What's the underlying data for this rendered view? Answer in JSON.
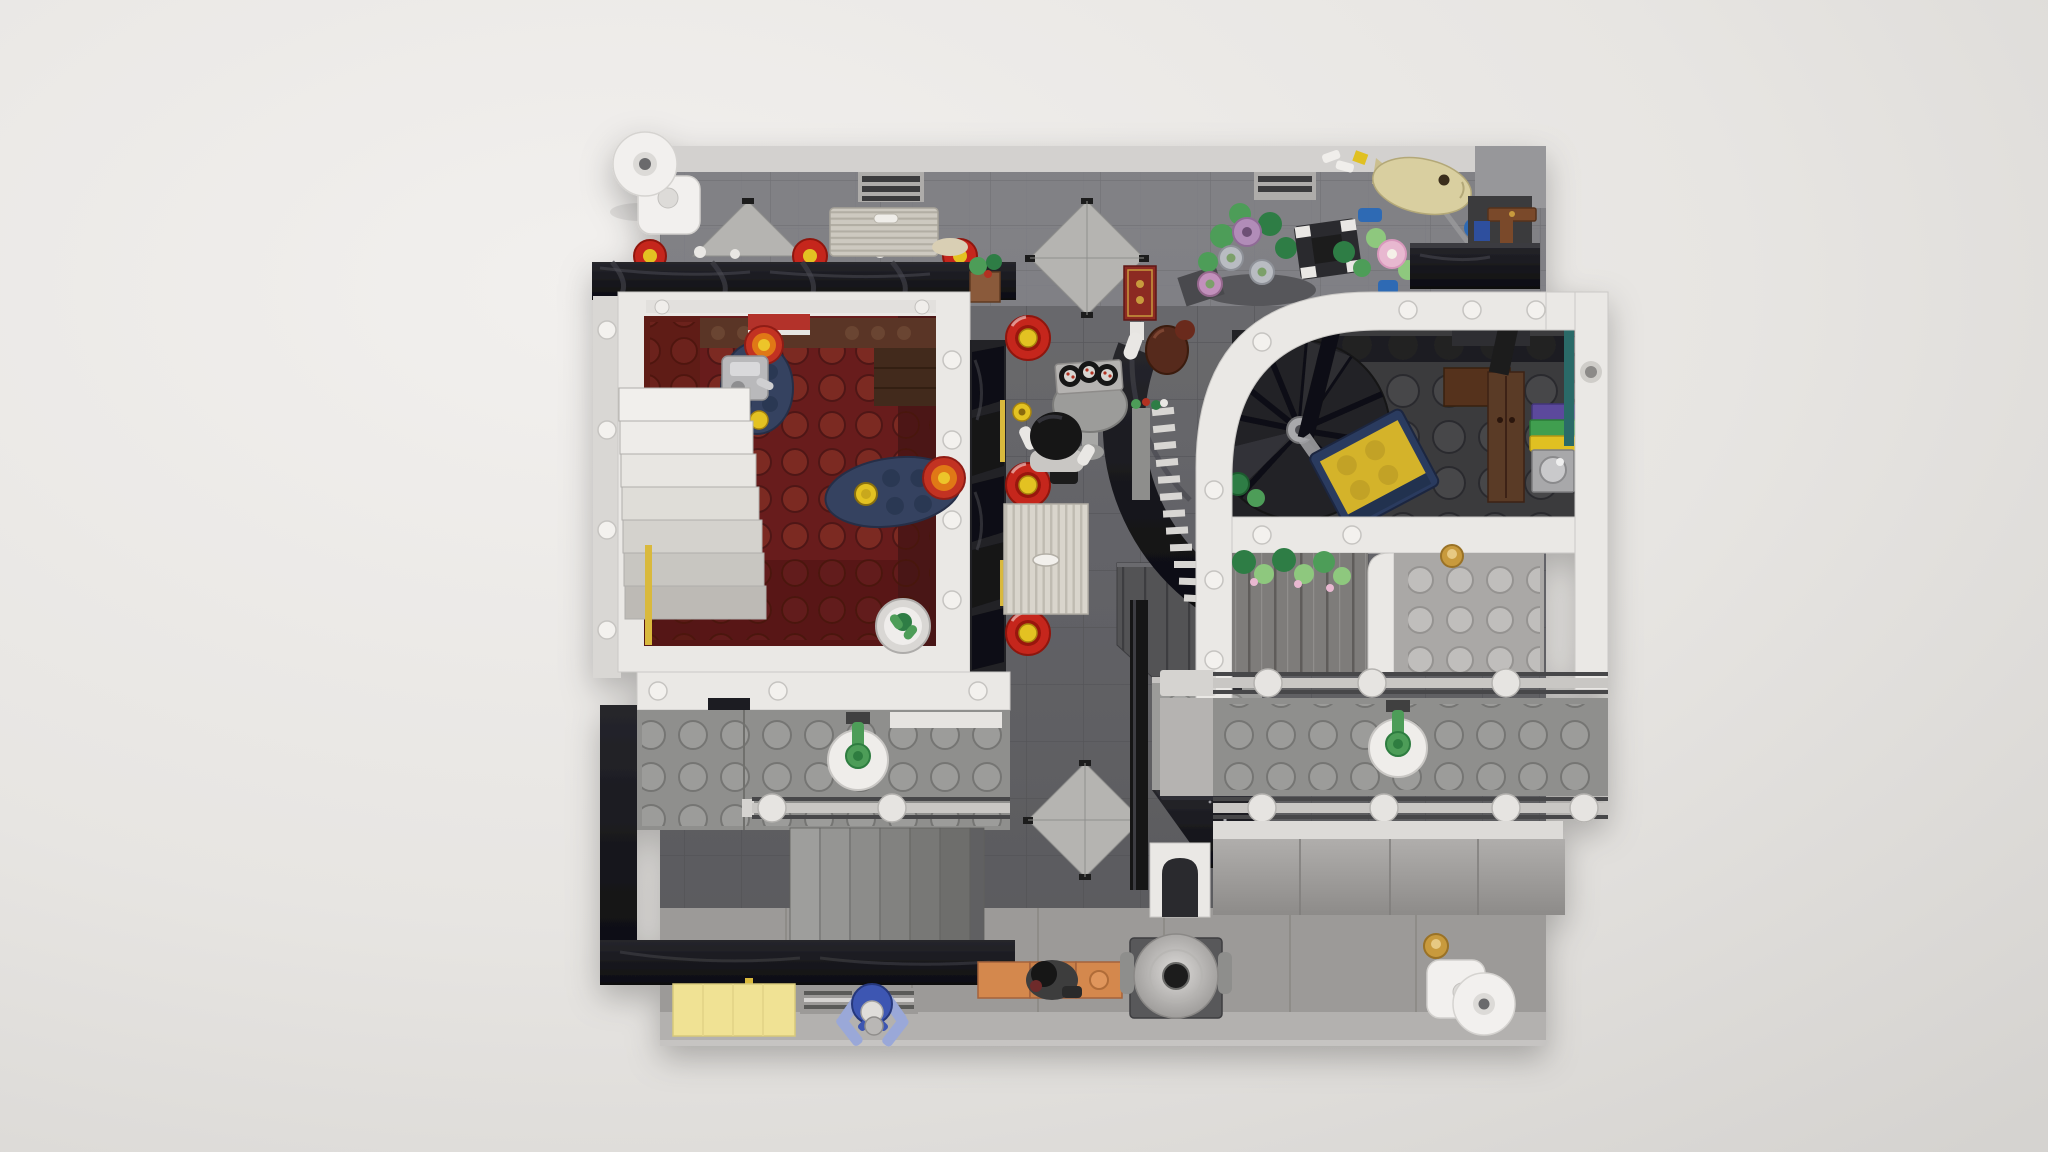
{
  "scene": {
    "type": "lego-top-down-render",
    "setting": "Overhead view of an open LEGO modular building interior on a dark gray tiled street baseplate with light sidewalk",
    "ground": {
      "baseplate": "dark gray tiles",
      "upper_wall_band": "gray brick tiles with light top edge",
      "diamond_inlays": 3,
      "sidewalk": "light gray panels",
      "vent_grilles": 2,
      "storm_drains": 2
    },
    "left_room": {
      "floor": "dark red studded plate",
      "features": [
        "white staircase of seven steps",
        "dark blue round table with espresso machine",
        "dark blue round table with yellow cup",
        "two red-orange target plates",
        "cactus in white pot",
        "brown counter bricks",
        "red wall sign",
        "yellow wall strip"
      ]
    },
    "street": {
      "red_stools": 3,
      "sushi_rolls": 3,
      "chef_minifig": 1,
      "ribbed_service_counter": 1,
      "red_gold_banner": 1,
      "brown_kettle": 1,
      "tan_roller_shutter": 1,
      "black_awning_lanterns": 3,
      "conveyor_grill_rungs": 12
    },
    "right_room": {
      "floor": "dark gray studded plate",
      "curved_white_wall": true,
      "features": [
        "black spiral staircase",
        "bed with yellow blanket and dark blue frame",
        "brown wardrobe",
        "washing machine with towel stack purple green yellow",
        "teal wall strip",
        "green bottles"
      ]
    },
    "lower_level": {
      "left_terrace": {
        "railing_posts": 2,
        "green_valve_table": 1,
        "stair_steps": 6
      },
      "right_terrace": {
        "railing_posts_top": 3,
        "railing_posts_bottom": 4,
        "green_valve_table": 1,
        "hanging_plants": true,
        "gold_stud": 2
      },
      "center": [
        "metal plank deck",
        "studded block wall",
        "black glossy wedge roof",
        "white arched doorway"
      ]
    },
    "roof_garden": {
      "flowers": [
        "lavender",
        "silver",
        "purple",
        "pink"
      ],
      "planter_with_white_corners": 1,
      "gray_bowl": 1,
      "koi_fish_statue": 1,
      "torii_shrine_pieces": true
    },
    "props": {
      "street_lamps": 2,
      "stone_fountain": 1,
      "orange_bench_with_minifig": 1,
      "blue_stool": 1,
      "yellow_awning": 1
    }
  },
  "palette": {
    "bg_light": "#f2f0ee",
    "bg_mid": "#e7e5e2",
    "bg_dark": "#d5d3d0",
    "plate": "#636367",
    "plate_line": "#4e4e52",
    "plate_top_tiles": "#85858a",
    "plate_top_light": "#d3d1cf",
    "diamond": "#b5b4b1",
    "sidewalk": "#9c9a98",
    "sidewalk_light": "#b3b1af",
    "white_wall": "#eae8e5",
    "white_wall_edge": "#cbc9c6",
    "stud_white": "#f3f1ee",
    "black_gloss": "#16161a",
    "black_gloss_hl": "#3d3d44",
    "red_floor": "#671f1b",
    "red_floor_stud": "#7c2b24",
    "brown_counter": "#5a3626",
    "brown_dark": "#43291a",
    "stair_top": "#f1efec",
    "stair_bottom": "#bdbab5",
    "table_blue": "#364360",
    "table_blue_stud": "#2c3852",
    "target_red": "#c23323",
    "target_orange": "#e07818",
    "target_yellow": "#ecc52a",
    "stool_red": "#c5281c",
    "stool_red_dark": "#991710",
    "stool_yellow": "#e3c221",
    "cream_counter": "#d9d5cc",
    "cream_rib": "#bfbbb1",
    "shutter_tan": "#cdc9c0",
    "shutter_rib": "#b2aea4",
    "room_floor": "#3a3a3d",
    "room_stud": "#47474b",
    "spiral_dark": "#232327",
    "spiral_mid": "#2e2e33",
    "spiral_hl": "#3a3a40",
    "metal": "#a9a9ac",
    "bed_blue": "#2c3b5e",
    "bed_yellow": "#d4b32c",
    "bed_yellow_stud": "#c2a226",
    "planks_metal": "#7e7c7a",
    "planks_dark": "#525255",
    "plank_line": "#5e5c5a",
    "terrace": "#8f8f8d",
    "terrace_stud": "#9c9c9a",
    "light_plate": "#aaa8a6",
    "light_plate_stud": "#c0bebc",
    "rail": "#c9c7c4",
    "groove": "#46464a",
    "post": "#e6e4e1",
    "green": "#4d9d58",
    "green_dark": "#2f7d45",
    "green_light": "#8ec87e",
    "pink": "#e8b8d0",
    "lavender": "#b18cb8",
    "silver_flower": "#b9bcc2",
    "purple_flower": "#c290bc",
    "teal": "#2a6a68",
    "box_purple": "#5c4a9c",
    "box_green": "#3f9e4f",
    "box_yellow": "#e0c020",
    "machine": "#a8a8aa",
    "fish_tan": "#d9cfa0",
    "awning_yellow": "#f0e294",
    "stool_blue": "#3d56b2",
    "stool_blue_light": "#9aa8d8",
    "lamp_white": "#f2f0ee",
    "banner_red": "#8c2a22",
    "gold": "#c89a3c",
    "gold_light": "#e7c983",
    "bench_orange": "#d4884e",
    "fountain_base": "#58585a",
    "cone_light": "#dcdad8",
    "cone_dark": "#999795",
    "kettle": "#57291b",
    "wardrobe": "#5a3a26",
    "blue_part": "#2e6bb4",
    "minifig_dark": "#3c3c3e",
    "hair_black": "#121215"
  }
}
